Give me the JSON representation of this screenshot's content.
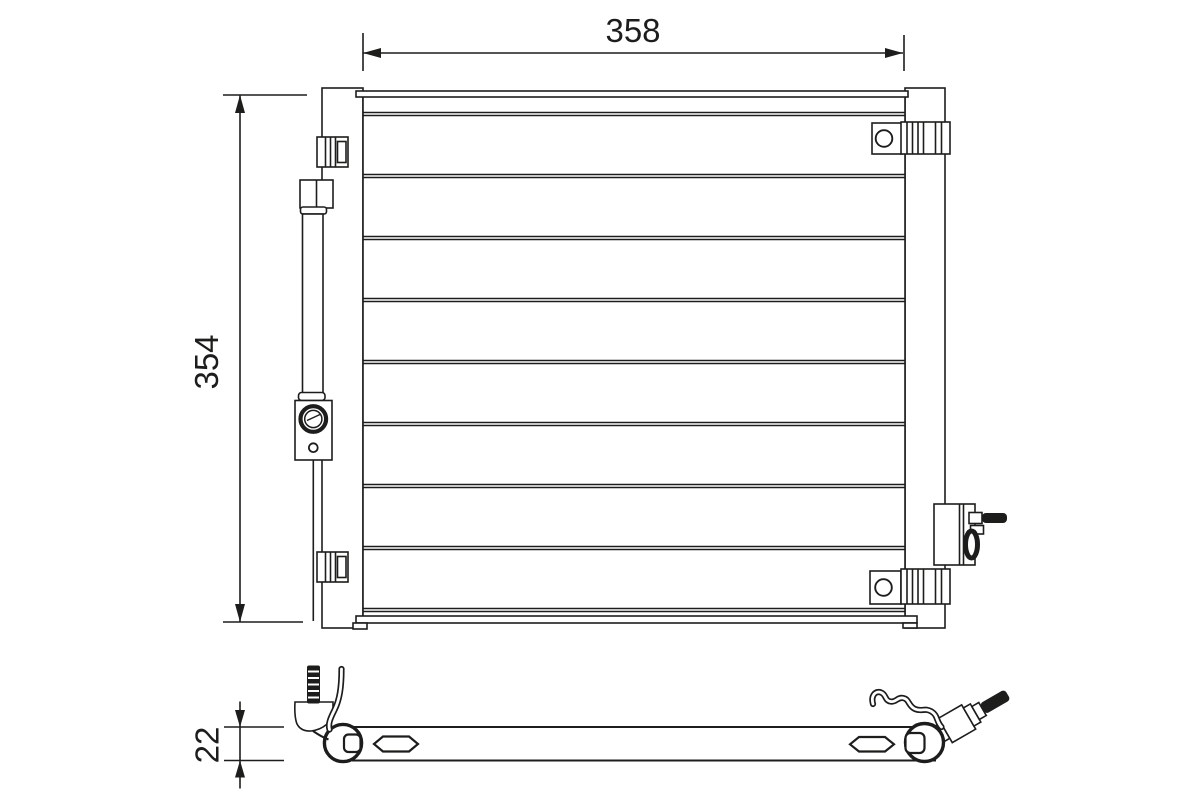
{
  "drawing": {
    "background": "#ffffff",
    "line_color": "#1d1d1b",
    "dim_width": "358",
    "dim_height": "354",
    "dim_depth": "22",
    "tube_lines_y": [
      114,
      176,
      238,
      300,
      362,
      424,
      486,
      548,
      610
    ],
    "tube_x1": 363,
    "tube_x2": 905
  }
}
